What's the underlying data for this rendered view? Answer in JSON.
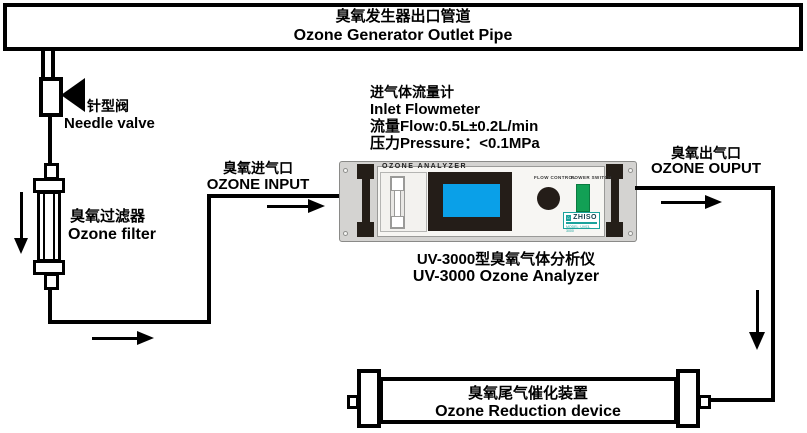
{
  "banner": {
    "title_zh": "臭氧发生器出口管道",
    "title_en": "Ozone Generator Outlet Pipe"
  },
  "needle_valve": {
    "label_zh": "针型阀",
    "label_en": "Needle valve"
  },
  "ozone_filter": {
    "label_zh": "臭氧过滤器",
    "label_en": "Ozone filter"
  },
  "input_port": {
    "label_zh": "臭氧进气口",
    "label_en": "OZONE INPUT"
  },
  "flowmeter_note": {
    "lines": [
      "进气体流量计",
      "Inlet Flowmeter",
      "流量Flow:0.5L±0.2L/min",
      "压力Pressure：<0.1MPa"
    ]
  },
  "analyzer": {
    "panel_title": "OZONE ANALYZER",
    "flow_control_label": "FLOW CONTROL",
    "power_switch_label": "POWER SWITCH",
    "brand": "ZHISO",
    "model": "MODEL: UV03-3000",
    "caption_zh": "UV-3000型臭氧气体分析仪",
    "caption_en": "UV-3000 Ozone Analyzer"
  },
  "output_port": {
    "label_zh": "臭氧出气口",
    "label_en": "OZONE OUPUT"
  },
  "reduction_device": {
    "label_zh": "臭氧尾气催化装置",
    "label_en": "Ozone Reduction device"
  },
  "colors": {
    "screen_blue": "#0aa0e8",
    "bezel_black": "#241d18",
    "power_green": "#12a055",
    "brand_teal": "#1ba39c",
    "casing_gray": "#d4d3d1",
    "panel_white": "#f7f6f3"
  }
}
